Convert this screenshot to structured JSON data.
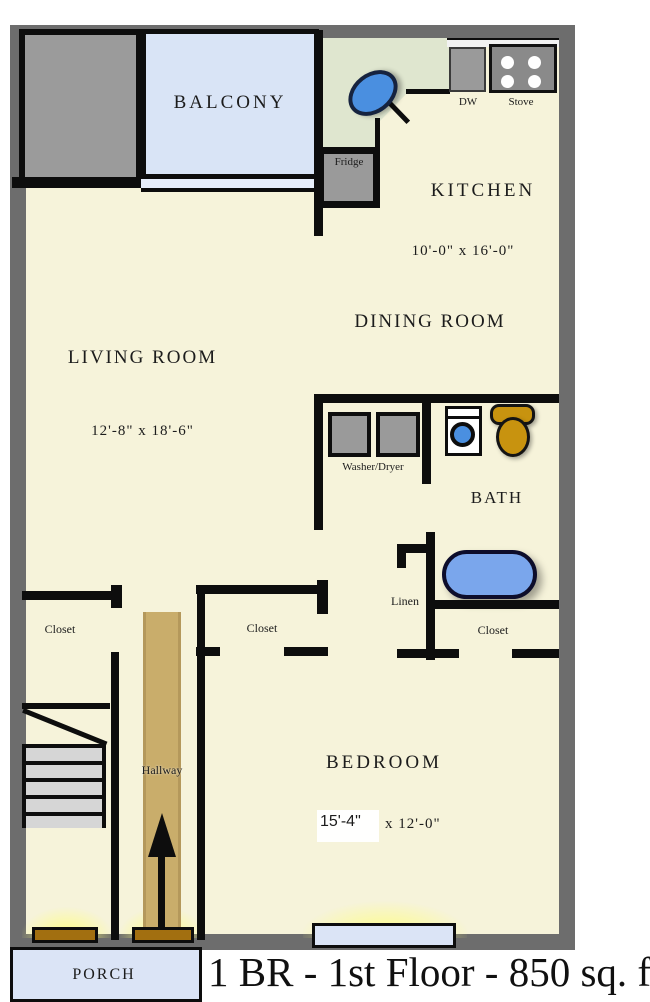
{
  "title": "1 BR - 1st Floor - 850 sq. ft",
  "rooms": {
    "balcony": {
      "label": "BALCONY"
    },
    "kitchen": {
      "label": "KITCHEN",
      "dims": "10'-0\" x 16'-0\""
    },
    "dining_room": {
      "label": "DINING ROOM"
    },
    "living_room": {
      "label": "LIVING ROOM",
      "dims": "12'-8\" x 18'-6\""
    },
    "bath": {
      "label": "BATH"
    },
    "bedroom": {
      "label": "BEDROOM",
      "dims_primary": "15'-4\"",
      "dims_secondary": "x 12'-0\""
    },
    "hallway": {
      "label": "Hallway"
    },
    "porch": {
      "label": "PORCH"
    }
  },
  "fixtures": {
    "dishwasher": "DW",
    "stove": "Stove",
    "fridge": "Fridge",
    "washer_dryer": "Washer/Dryer",
    "linen": "Linen",
    "closet_left": "Closet",
    "closet_bedroom": "Closet",
    "closet_bath": "Closet"
  },
  "colors": {
    "outer_wall": "#6d6d6d",
    "inner_wall": "#0d0d0d",
    "floor": "#f6f3da",
    "balcony_fill": "#d9e4f6",
    "counter_fill": "#dfe6cf",
    "sink_water": "#4a8fe0",
    "bathtub_fill": "#7aa6ec",
    "toilet_fill": "#c8930f",
    "hallway_runner": "#c9ad6b",
    "porch_fill": "#dbe4f6",
    "door_glow": "#ffff78",
    "appliance_gray": "#9a9a9a",
    "threshold_brown": "#a26f10"
  }
}
